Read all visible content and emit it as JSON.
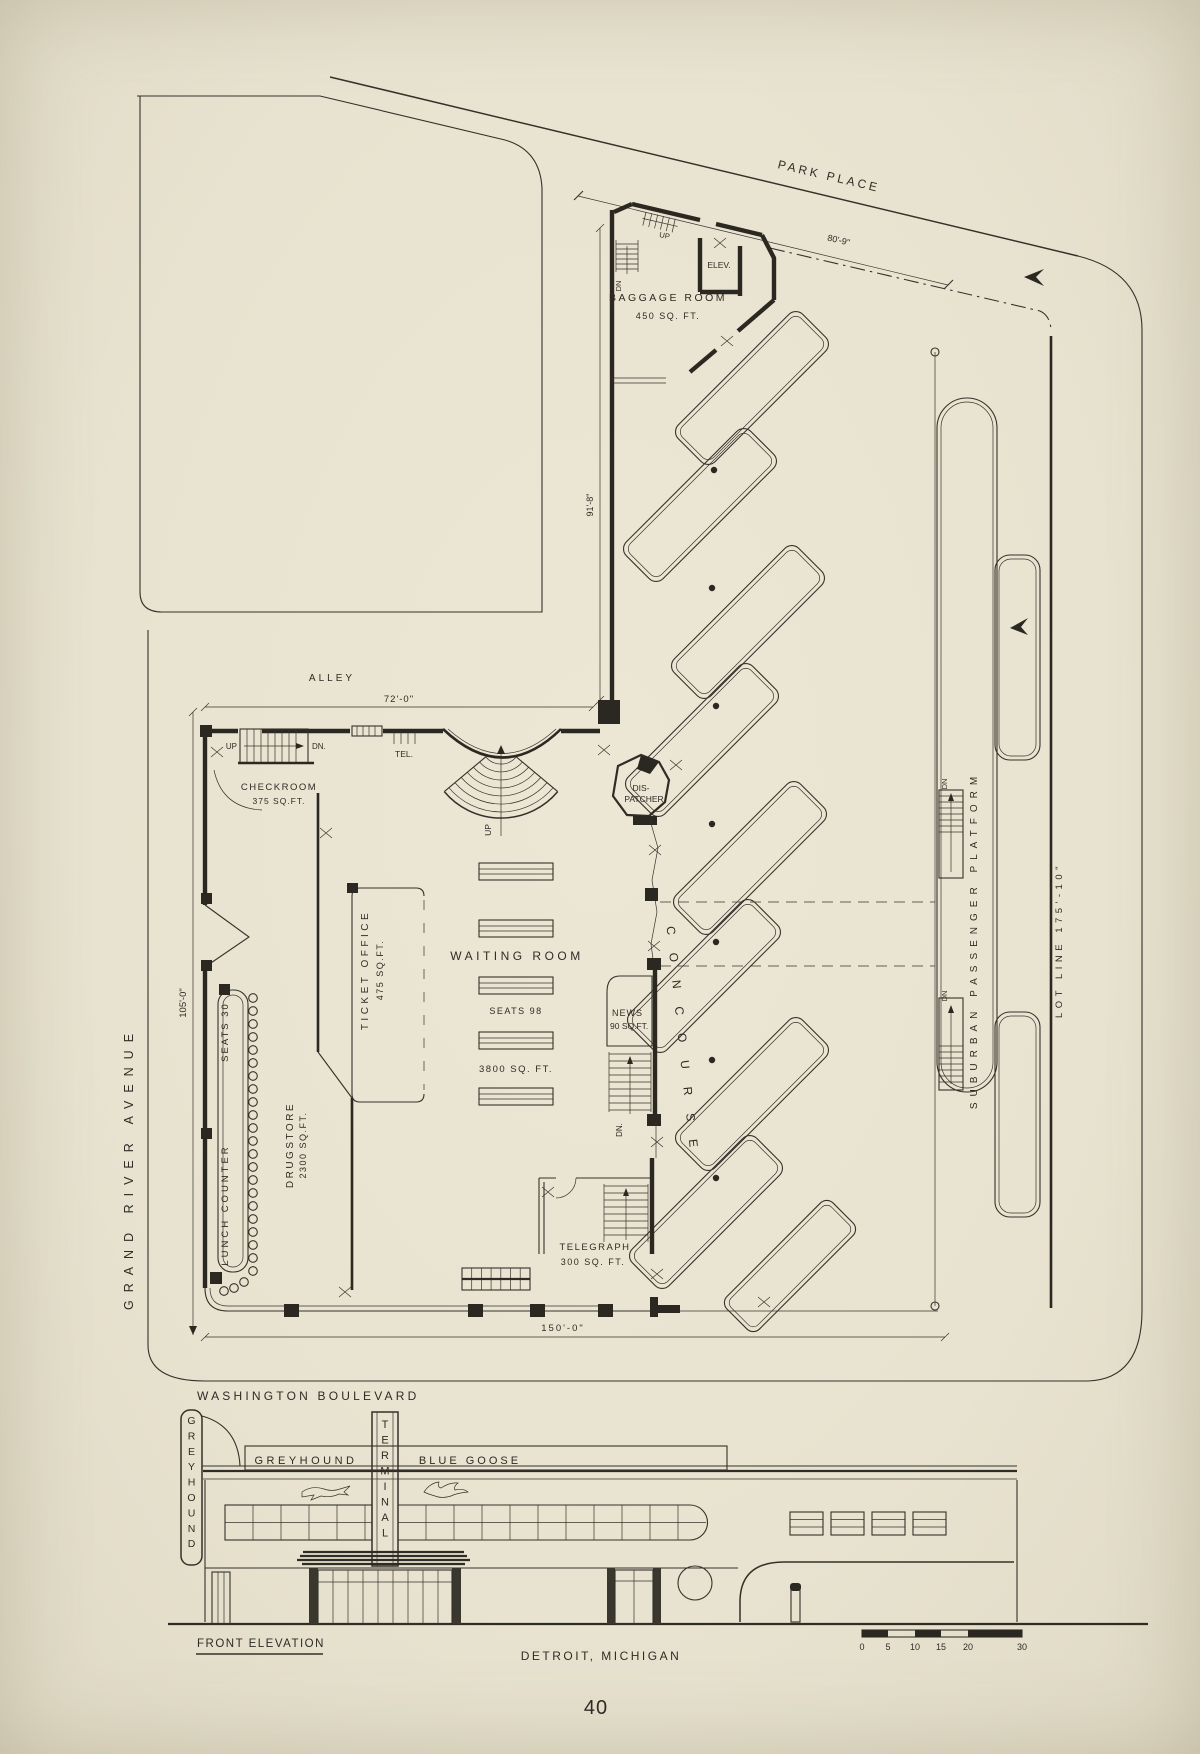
{
  "page_number": "40",
  "plan": {
    "streets": {
      "park_place": "PARK PLACE",
      "grand_river_avenue": "GRAND RIVER AVENUE",
      "washington_boulevard": "WASHINGTON BOULEVARD",
      "alley": "ALLEY"
    },
    "dimensions": {
      "park_place_frontage": "80'-9\"",
      "concourse_depth": "91'-8\"",
      "alley_frontage": "72'-0\"",
      "grand_river_frontage": "105'-0\"",
      "washington_frontage": "150'-0\"",
      "lot_line": "LOT LINE   175'-10\""
    },
    "rooms": {
      "baggage_room": {
        "name": "BAGGAGE ROOM",
        "area": "450 SQ. FT."
      },
      "checkroom": {
        "name": "CHECKROOM",
        "area": "375 SQ.FT."
      },
      "ticket_office": {
        "name": "TICKET OFFICE",
        "area": "475 SQ.FT."
      },
      "waiting_room": {
        "name": "WAITING   ROOM",
        "seats": "SEATS 98",
        "area": "3800   SQ. FT."
      },
      "drugstore": {
        "name": "DRUGSTORE",
        "area": "2300 SQ.FT."
      },
      "lunch_counter": {
        "name": "LUNCH COUNTER",
        "seats": "SEATS 30"
      },
      "news_stand": {
        "name": "NEWS",
        "area": "90 SQ.FT."
      },
      "telegraph": {
        "name": "TELEGRAPH",
        "area": "300 SQ. FT."
      },
      "dispatcher": {
        "line1": "DIS-",
        "line2": "PATCHER"
      },
      "concourse": "CONCOURSE",
      "platform": "SUBURBAN PASSENGER PLATFORM",
      "elevator": "ELEV.",
      "telephone": "TEL."
    },
    "annotations": {
      "up": "UP",
      "down": "DN.",
      "down_short": "DN"
    }
  },
  "elevation": {
    "title": "FRONT ELEVATION",
    "caption": "DETROIT,  MICHIGAN",
    "blade_sign": "GREYHOUND",
    "pylon_sign": "TERMINAL",
    "band_sign_left": "GREYHOUND",
    "band_sign_right": "BLUE GOOSE",
    "scale_ticks": [
      "0",
      "5",
      "10",
      "15",
      "20",
      "30"
    ]
  }
}
